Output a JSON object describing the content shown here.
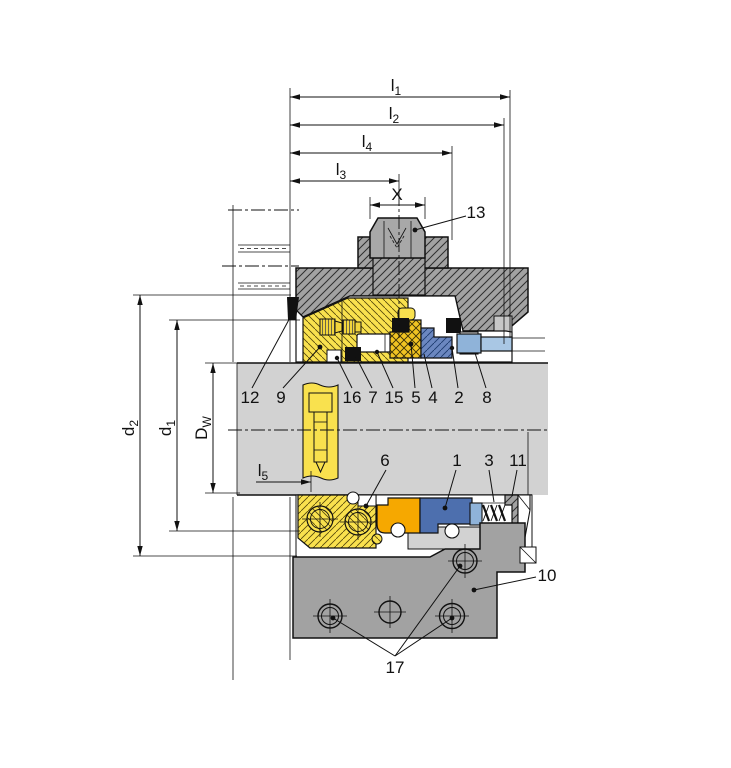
{
  "dimension_labels": {
    "l1": {
      "base": "l",
      "sub": "1"
    },
    "l2": {
      "base": "l",
      "sub": "2"
    },
    "l4": {
      "base": "l",
      "sub": "4"
    },
    "l3": {
      "base": "l",
      "sub": "3"
    },
    "x": {
      "base": "X",
      "sub": ""
    },
    "l5": {
      "base": "l",
      "sub": "5"
    },
    "d2": {
      "base": "d",
      "sub": "2"
    },
    "d1": {
      "base": "d",
      "sub": "1"
    },
    "dw": {
      "base": "D",
      "sub": "W"
    }
  },
  "part_labels": {
    "p1": "1",
    "p2": "2",
    "p3": "3",
    "p4": "4",
    "p5": "5",
    "p6": "6",
    "p7": "7",
    "p8": "8",
    "p9": "9",
    "p10": "10",
    "p11": "11",
    "p12": "12",
    "p13": "13",
    "p15": "15",
    "p16": "16",
    "p17": "17"
  },
  "colors": {
    "shaft-gray": "#d2d2d2",
    "housing-gray": "#a2a2a2",
    "flange-gray": "#a2a2a2",
    "seal-yellow": "#f9e14e",
    "packing-gold": "#f0c322",
    "orange-part": "#f6a800",
    "blue-dark": "#4d6fae",
    "blue-hatch": "#6b87c0",
    "blue-light": "#8fb3d9",
    "blue-lighter": "#a9c7e4",
    "line-black": "#111111",
    "gasket-black": "#111111"
  }
}
